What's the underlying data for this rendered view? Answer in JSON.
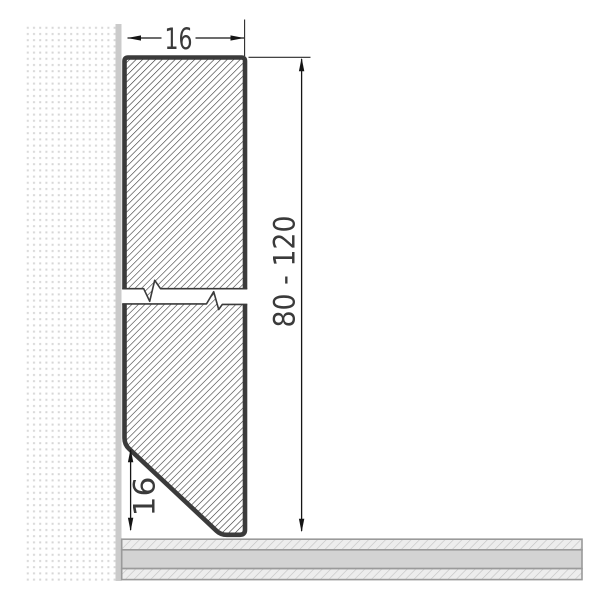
{
  "drawing": {
    "type": "skirting-board-cross-section",
    "labels": {
      "width": "16",
      "height_range": "80 - 120",
      "chamfer": "16"
    },
    "colors": {
      "profile_outline": "#3b3b3b",
      "profile_hatch_line": "#303030",
      "wall_dots": "#d7d7d7",
      "wall_face": "#cbcbcb",
      "floor_solid_fill": "#d3d3d3",
      "floor_hatch_line": "#c2c2c2",
      "floor_border": "#9a9a9a",
      "dimension_line": "#151515",
      "label_text": "#3a3a3a"
    }
  }
}
